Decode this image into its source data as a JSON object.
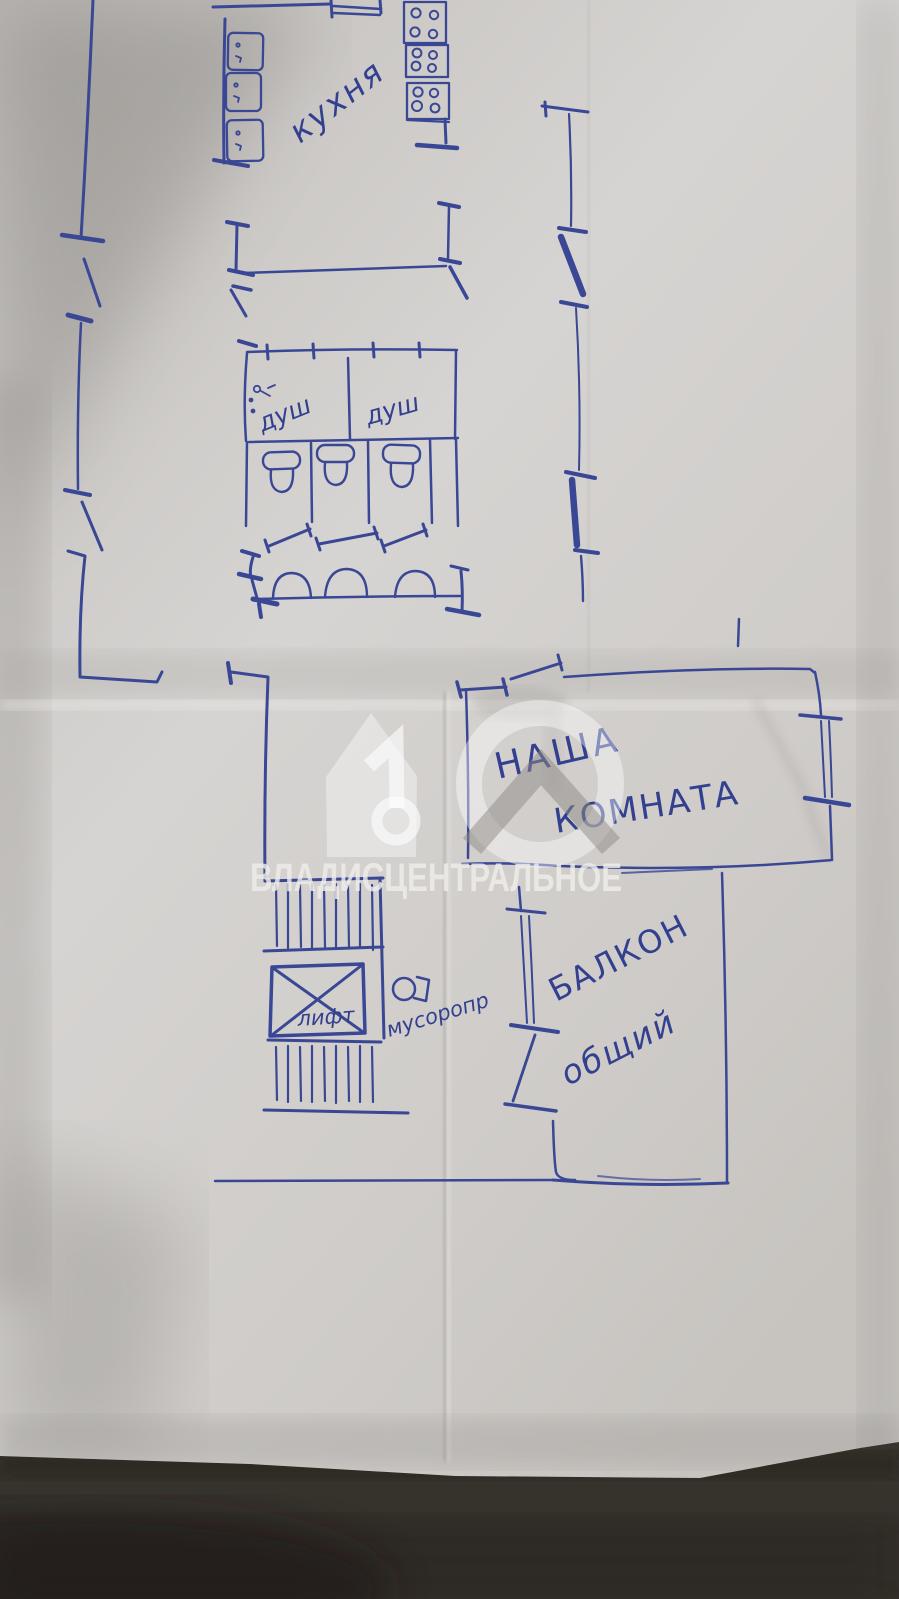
{
  "photo": {
    "description": "Photo of a hand-drawn floor plan of a communal flat, blue ballpoint pen on creased paper",
    "language": "ru"
  },
  "rooms": {
    "kitchen": "кухня",
    "shower_left": "душ",
    "shower_right": "душ",
    "our_room_line1": "НАША",
    "our_room_line2": "КОМНАТА",
    "balcony_line1": "БАЛКОН",
    "balcony_line2": "общий",
    "lift": "лифт",
    "garbage_chute": "мусоропр"
  },
  "fixtures": {
    "stove_units_right_wall": 3,
    "kitchen_tables_left_wall": 3,
    "shower_cabins": 2,
    "toilets": 3,
    "sinks": 3,
    "stair_flights": 2,
    "lift_shafts": 1,
    "garbage_chutes": 1
  },
  "watermark": {
    "text": "ВЛАДИСЦЕНТРАЛЬНОЕ",
    "logo": "vladis-house-10-key-logo"
  },
  "colors": {
    "ink": "#3a4795",
    "paper": "#d2cfcc",
    "paper_shadow": "#8a8783",
    "table": "#46413b",
    "watermark_text": "#f0eeeb"
  }
}
